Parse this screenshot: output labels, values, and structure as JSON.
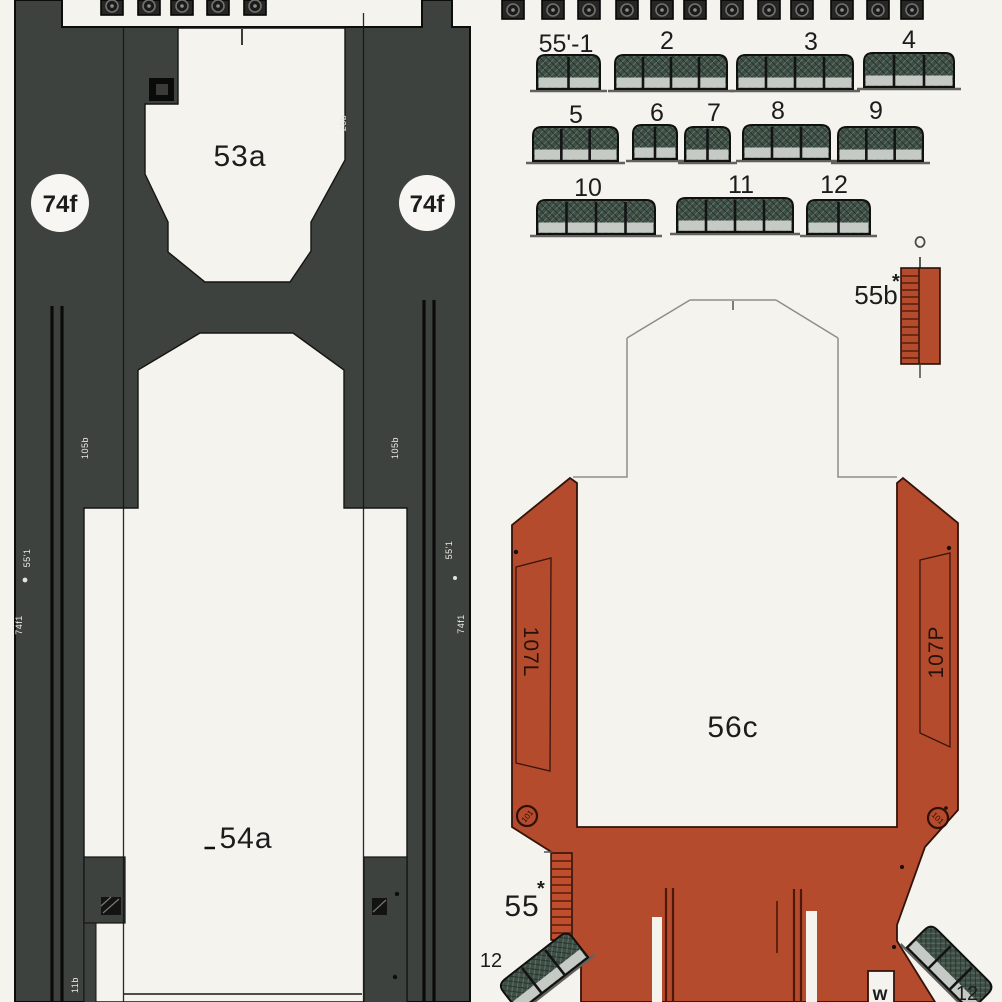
{
  "colors": {
    "deck_dark": "#3e423e",
    "hull_red": "#b54b2d",
    "fence_green": "#3f4f45",
    "band_gray": "#c6cac4",
    "page_bg": "#f4f3ee"
  },
  "deck_piece": {
    "top_cutout_label": "53a",
    "bottom_cutout_label": "54a",
    "left_circle_label": "74f",
    "right_circle_label": "74f",
    "tiny_top_label": "25b",
    "tiny_inner_left": "105b",
    "tiny_inner_right": "105b",
    "tiny_edge_left_1": "55'1",
    "tiny_edge_left_2": "74f1",
    "tiny_edge_right_1": "55'1",
    "tiny_edge_right_2": "74f1",
    "tiny_bottom_left": "11b"
  },
  "fence_strip_labels": [
    "55'-1",
    "2",
    "3",
    "4",
    "5",
    "6",
    "7",
    "8",
    "9",
    "10",
    "11",
    "12"
  ],
  "corner_fences": {
    "left_label": "12",
    "right_label": "12"
  },
  "small_ladder": {
    "label": "55b",
    "star": "*"
  },
  "hull_ladder": {
    "label": "55",
    "star": "*"
  },
  "hull_piece": {
    "label": "56c",
    "left_side_label": "107L",
    "right_side_label": "107P",
    "left_bolt_label": "101",
    "right_bolt_label": "101",
    "notch_label": "w"
  }
}
